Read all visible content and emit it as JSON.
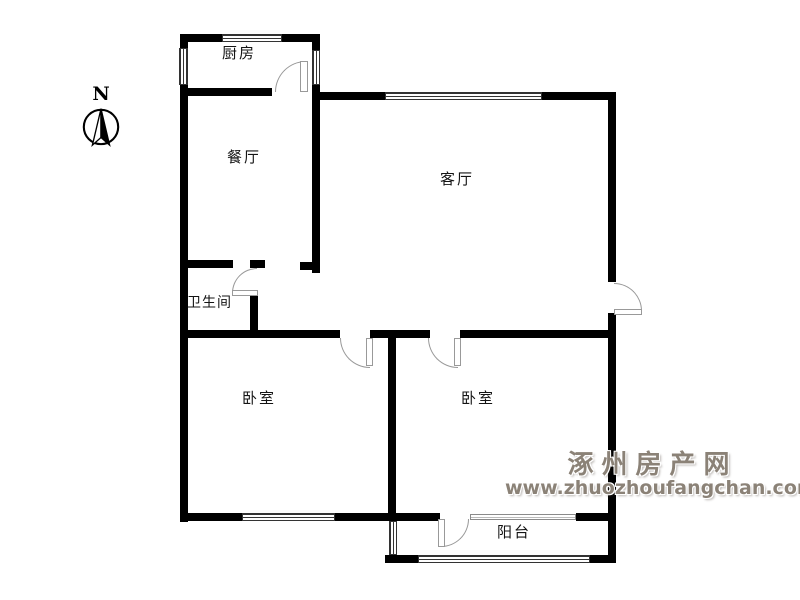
{
  "compass": {
    "north_label": "N"
  },
  "rooms": {
    "kitchen": {
      "label": "厨房"
    },
    "dining": {
      "label": "餐厅"
    },
    "living": {
      "label": "客厅"
    },
    "bathroom": {
      "label": "卫生间"
    },
    "bedroom_left": {
      "label": "卧室"
    },
    "bedroom_right": {
      "label": "卧室"
    },
    "balcony": {
      "label": "阳台"
    }
  },
  "watermark": {
    "site_name": "涿州房产网",
    "site_url": "www.zhuozhoufangchan.com"
  },
  "colors": {
    "wall": "#000000",
    "line": "#999999",
    "label": "#141414",
    "wm": "#8b8277"
  }
}
